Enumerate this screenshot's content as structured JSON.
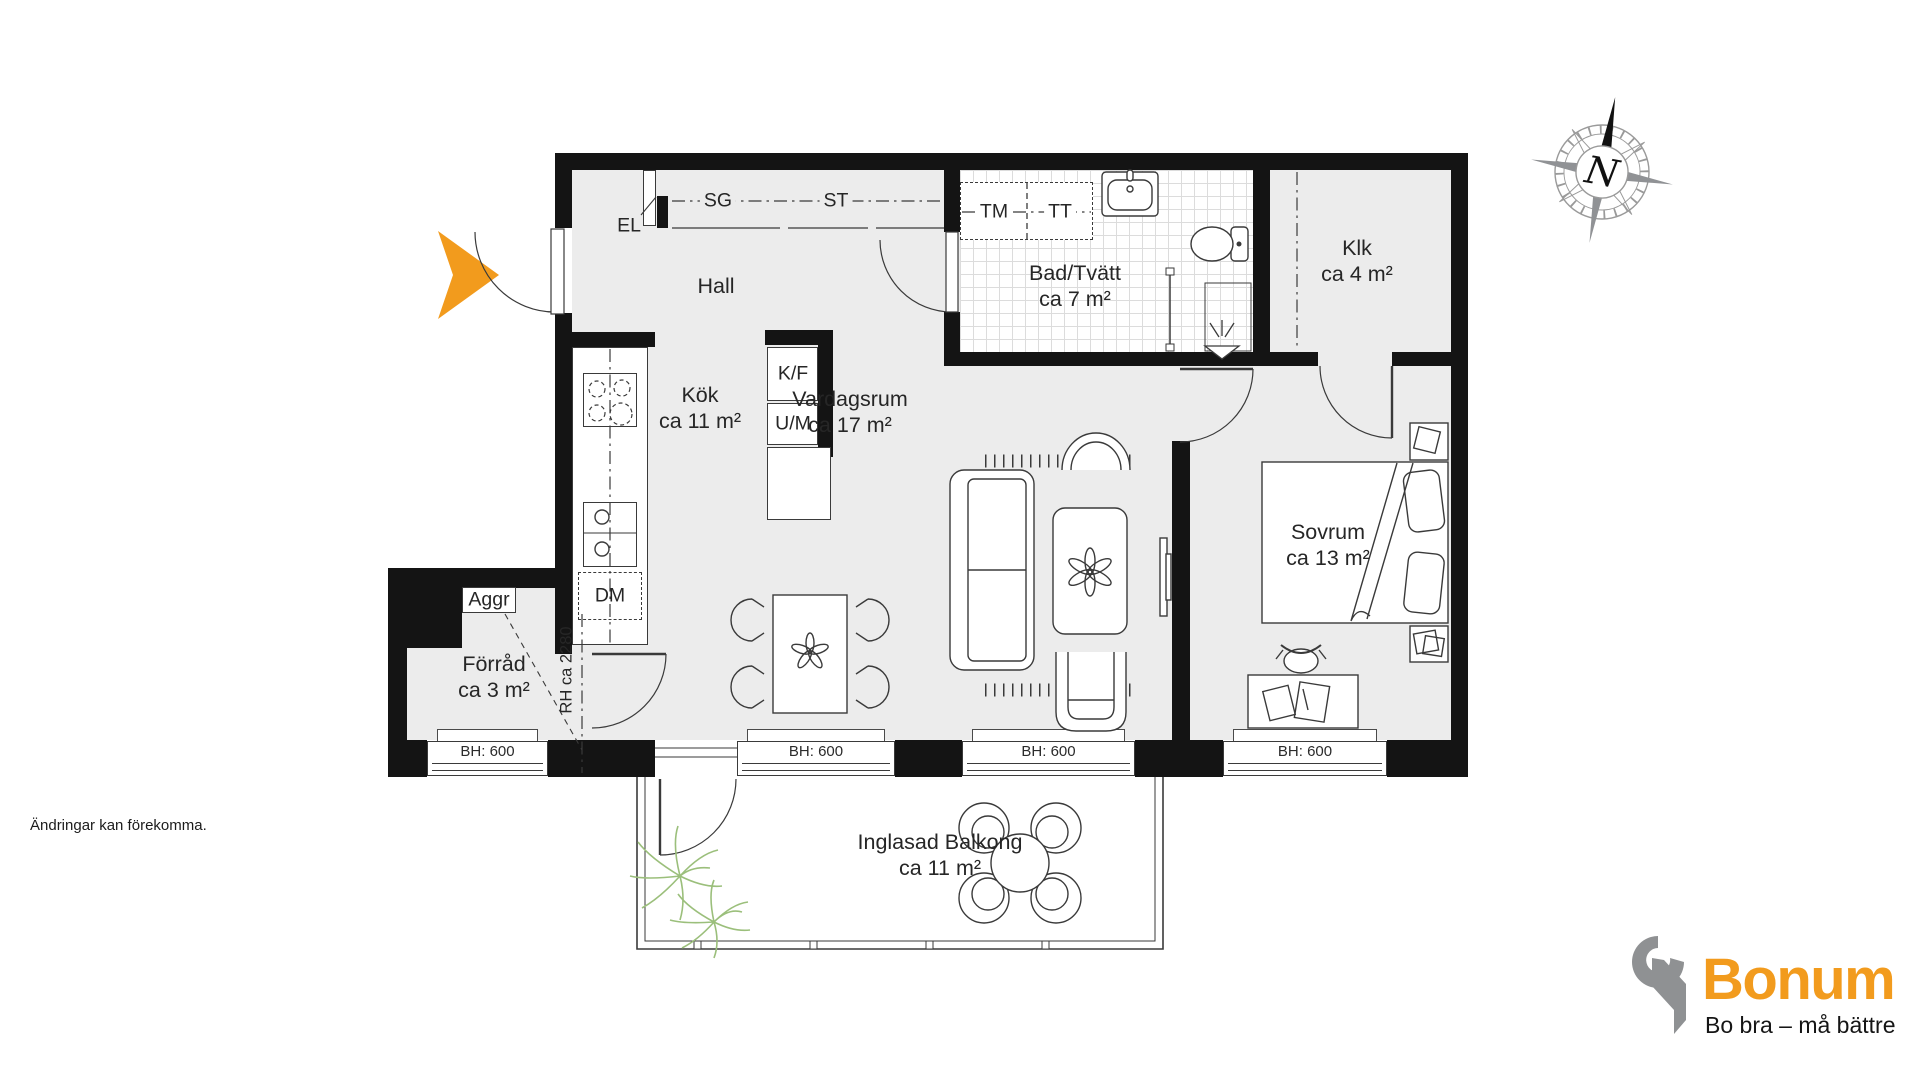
{
  "colors": {
    "accent": "#F29B1D",
    "logo_gray": "#8F9193",
    "wall": "#141414",
    "floor": "#ECECEC"
  },
  "compass": {
    "label": "N"
  },
  "rooms": {
    "hall": {
      "name": "Hall"
    },
    "kok": {
      "name": "Kök",
      "area": "ca 11 m²"
    },
    "vardagsrum": {
      "name": "Vardagsrum",
      "area": "ca 17 m²"
    },
    "bad": {
      "name": "Bad/Tvätt",
      "area": "ca 7 m²"
    },
    "klk": {
      "name": "Klk",
      "area": "ca 4 m²"
    },
    "sovrum": {
      "name": "Sovrum",
      "area": "ca 13 m²"
    },
    "forrad": {
      "name": "Förråd",
      "area": "ca 3 m²"
    },
    "balkong": {
      "name": "Inglasad Balkong",
      "area": "ca 11 m²"
    }
  },
  "fixtures": {
    "el": "EL",
    "sg": "SG",
    "st": "ST",
    "tm": "TM",
    "tt": "TT",
    "kf": "K/F",
    "um": "U/M",
    "dm": "DM",
    "aggr": "Aggr",
    "rh": "RH ca 2280"
  },
  "windows": {
    "labels": [
      "BH: 600",
      "BH: 600",
      "BH: 600",
      "BH: 600"
    ]
  },
  "brand": {
    "name": "Bonum",
    "tagline": "Bo bra – må bättre"
  },
  "footer": {
    "disclaimer": "Ändringar kan förekomma."
  }
}
